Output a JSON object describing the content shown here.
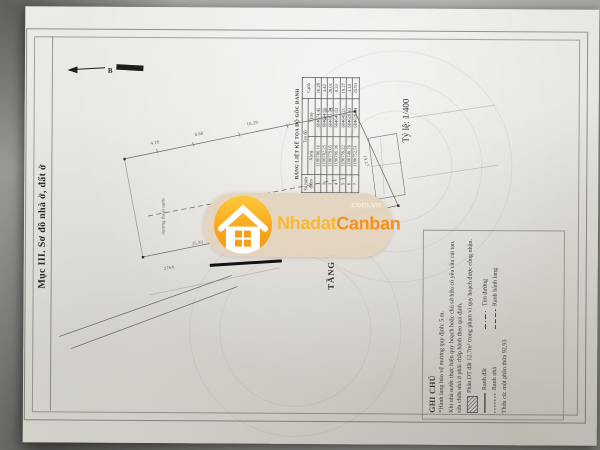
{
  "page": {
    "section_title": "Mục III. Sơ đồ nhà ở, đất ở",
    "scale_label": "Tỷ lệ: 1/400",
    "floor_label": "TẦNG 1",
    "north_label": "B"
  },
  "coordinate_table": {
    "title": "BẢNG LIỆT KÊ TỌA ĐỘ GÓC RANH",
    "columns": {
      "point": "Số hiệu điểm",
      "coords": "Tọa độ",
      "x": "X(m)",
      "y": "Y(m)",
      "edge": "Cạnh"
    },
    "rows": [
      {
        "point": "1",
        "x": "1190786.16",
        "y": "604674.45",
        "edge": "10.29"
      },
      {
        "point": "2",
        "x": "1190782.25",
        "y": "604664.95",
        "edge": "3.42"
      },
      {
        "point": "3",
        "x": "1190779.05",
        "y": "604663.74",
        "edge": "26.01"
      },
      {
        "point": "4",
        "x": "1190766.36",
        "y": "604641.03",
        "edge": "8.33"
      },
      {
        "point": "5",
        "x": "1190759.22",
        "y": "604645.21",
        "edge": "19.27"
      },
      {
        "point": "6",
        "x": "1190749.76",
        "y": "604628.43",
        "edge": "3.18"
      },
      {
        "point": "7",
        "x": "1190752.51",
        "y": "604626.84",
        "edge": "25.93"
      }
    ]
  },
  "notes": {
    "title": "GHI CHÚ",
    "line1": "*Hành lang bảo vệ mương quy định: 5 m.",
    "line2": "Khi nhà nước thực hiện quy hoạch hoặc chủ sở hữu có yêu cầu cải tạo, sửa chữa nhà ở phải chấp hành theo qui định.",
    "hatch_note": "Phần DT đất 12.7m² trong phạm vi quy hoạch được công nhận.",
    "legend": [
      {
        "label": "Ranh đất"
      },
      {
        "label": "Tim đường"
      },
      {
        "label": "Ranh nhà"
      },
      {
        "label": "Ranh hành lang"
      }
    ],
    "old_parcel": "Thửa cũ: một phần thửa 92,93"
  },
  "watermark": {
    "brand_part1": "Nhadat",
    "brand_part2": "Canban",
    "domain": ".com.vn",
    "badge_color": "#e3d4bf",
    "orange_light": "#fbb92d",
    "orange_dark": "#f78f1b"
  },
  "drawing": {
    "dims": [
      "4.19",
      "8.60",
      "10.29",
      "3.42",
      "19.27",
      "25.93"
    ],
    "labels": {
      "canal": "mương thoát nước",
      "address": "276A"
    }
  }
}
